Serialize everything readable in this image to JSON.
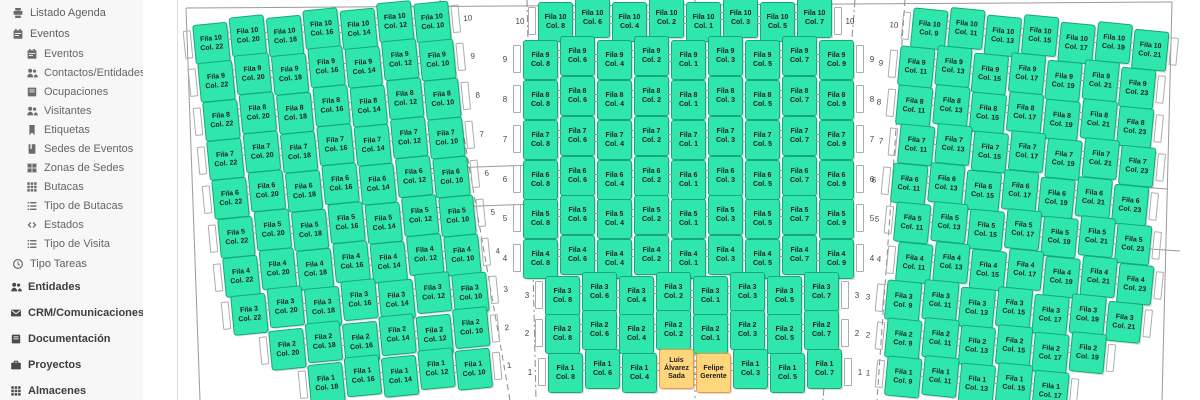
{
  "sidebar": {
    "items": [
      {
        "label": "Listado Agenda",
        "icon": "print",
        "level": "top"
      },
      {
        "label": "Eventos",
        "icon": "calendar",
        "level": "top"
      },
      {
        "label": "Eventos",
        "icon": "calendar",
        "level": "sub"
      },
      {
        "label": "Contactos/Entidades",
        "icon": "users",
        "level": "sub"
      },
      {
        "label": "Ocupaciones",
        "icon": "address-book",
        "level": "sub"
      },
      {
        "label": "Visitantes",
        "icon": "users",
        "level": "sub"
      },
      {
        "label": "Etiquetas",
        "icon": "bookmark",
        "level": "sub"
      },
      {
        "label": "Sedes de Eventos",
        "icon": "journal",
        "level": "sub"
      },
      {
        "label": "Zonas de Sedes",
        "icon": "grid-large",
        "level": "sub"
      },
      {
        "label": "Butacas",
        "icon": "grid",
        "level": "sub"
      },
      {
        "label": "Tipo de Butacas",
        "icon": "list",
        "level": "sub"
      },
      {
        "label": "Estados",
        "icon": "code",
        "level": "sub"
      },
      {
        "label": "Tipo de Visita",
        "icon": "list",
        "level": "sub"
      },
      {
        "label": "Tipo Tareas",
        "icon": "clock",
        "level": "top"
      },
      {
        "label": "Entidades",
        "icon": "users",
        "level": "main"
      },
      {
        "label": "CRM/Comunicaciones",
        "icon": "envelope",
        "level": "main"
      },
      {
        "label": "Documentación",
        "icon": "address-book",
        "level": "main"
      },
      {
        "label": "Proyectos",
        "icon": "briefcase",
        "level": "main"
      },
      {
        "label": "Almacenes",
        "icon": "grid",
        "level": "main"
      }
    ]
  },
  "seat_map": {
    "row_word": "Fila",
    "col_word": "Col.",
    "colors": {
      "seat_fill": "#2fe7ab",
      "seat_border": "#14a87c",
      "occupied_fill": "#ffd57e",
      "occupied_border": "#e89a3c"
    },
    "occupants": [
      {
        "section": "center",
        "row": 1,
        "col": 2,
        "name": "Luis Álvarez Sada"
      },
      {
        "section": "center",
        "row": 1,
        "col": 1,
        "name": "Felipe Gerente"
      }
    ],
    "sections": [
      {
        "name": "left",
        "rows": [
          {
            "row": 10,
            "cols": [
              22,
              20,
              18,
              16,
              14,
              12,
              10
            ]
          },
          {
            "row": 9,
            "cols": [
              22,
              20,
              18,
              16,
              14,
              12,
              10
            ]
          },
          {
            "row": 8,
            "cols": [
              22,
              20,
              18,
              16,
              14,
              12,
              10
            ]
          },
          {
            "row": 7,
            "cols": [
              22,
              20,
              18,
              16,
              14,
              12,
              10
            ]
          },
          {
            "row": 6,
            "cols": [
              22,
              20,
              18,
              16,
              14,
              12,
              10
            ]
          },
          {
            "row": 5,
            "cols": [
              22,
              20,
              18,
              16,
              14,
              12,
              10
            ]
          },
          {
            "row": 4,
            "cols": [
              22,
              20,
              18,
              16,
              14,
              12,
              10
            ]
          },
          {
            "row": 3,
            "cols": [
              22,
              20,
              18,
              16,
              14,
              12,
              10
            ]
          },
          {
            "row": 2,
            "cols": [
              20,
              18,
              16,
              14,
              12,
              10
            ]
          },
          {
            "row": 1,
            "cols": [
              18,
              16,
              14,
              12,
              10
            ]
          }
        ]
      },
      {
        "name": "center",
        "rows": [
          {
            "row": 10,
            "cols": [
              8,
              6,
              4,
              2,
              1,
              3,
              5,
              7
            ]
          },
          {
            "row": 9,
            "cols": [
              8,
              6,
              4,
              2,
              1,
              3,
              5,
              7,
              9
            ]
          },
          {
            "row": 8,
            "cols": [
              8,
              6,
              4,
              2,
              1,
              3,
              5,
              7,
              9
            ]
          },
          {
            "row": 7,
            "cols": [
              8,
              6,
              4,
              2,
              1,
              3,
              5,
              7,
              9
            ]
          },
          {
            "row": 6,
            "cols": [
              8,
              6,
              4,
              2,
              1,
              3,
              5,
              7,
              9
            ]
          },
          {
            "row": 5,
            "cols": [
              8,
              6,
              4,
              2,
              1,
              3,
              5,
              7,
              9
            ]
          },
          {
            "row": 4,
            "cols": [
              8,
              6,
              4,
              2,
              1,
              3,
              5,
              7,
              9
            ]
          },
          {
            "row": 3,
            "cols": [
              8,
              6,
              4,
              2,
              1,
              3,
              5,
              7
            ]
          },
          {
            "row": 2,
            "cols": [
              8,
              6,
              4,
              2,
              1,
              3,
              5,
              7
            ]
          },
          {
            "row": 1,
            "cols": [
              8,
              6,
              4,
              2,
              1,
              3,
              5,
              7
            ]
          }
        ]
      },
      {
        "name": "right",
        "rows": [
          {
            "row": 10,
            "cols": [
              9,
              11,
              13,
              15,
              17,
              19,
              21
            ]
          },
          {
            "row": 9,
            "cols": [
              11,
              13,
              15,
              17,
              19,
              21,
              23
            ]
          },
          {
            "row": 8,
            "cols": [
              11,
              13,
              15,
              17,
              19,
              21,
              23
            ]
          },
          {
            "row": 7,
            "cols": [
              11,
              13,
              15,
              17,
              19,
              21,
              23
            ]
          },
          {
            "row": 6,
            "cols": [
              11,
              13,
              15,
              17,
              19,
              21,
              23
            ]
          },
          {
            "row": 5,
            "cols": [
              11,
              13,
              15,
              17,
              19,
              21,
              23
            ]
          },
          {
            "row": 4,
            "cols": [
              11,
              13,
              15,
              17,
              19,
              21,
              23
            ]
          },
          {
            "row": 3,
            "cols": [
              9,
              11,
              13,
              15,
              17,
              19,
              21
            ]
          },
          {
            "row": 2,
            "cols": [
              9,
              11,
              13,
              15,
              17,
              19
            ]
          },
          {
            "row": 1,
            "cols": [
              9,
              11,
              13,
              15,
              17
            ]
          }
        ]
      }
    ]
  }
}
